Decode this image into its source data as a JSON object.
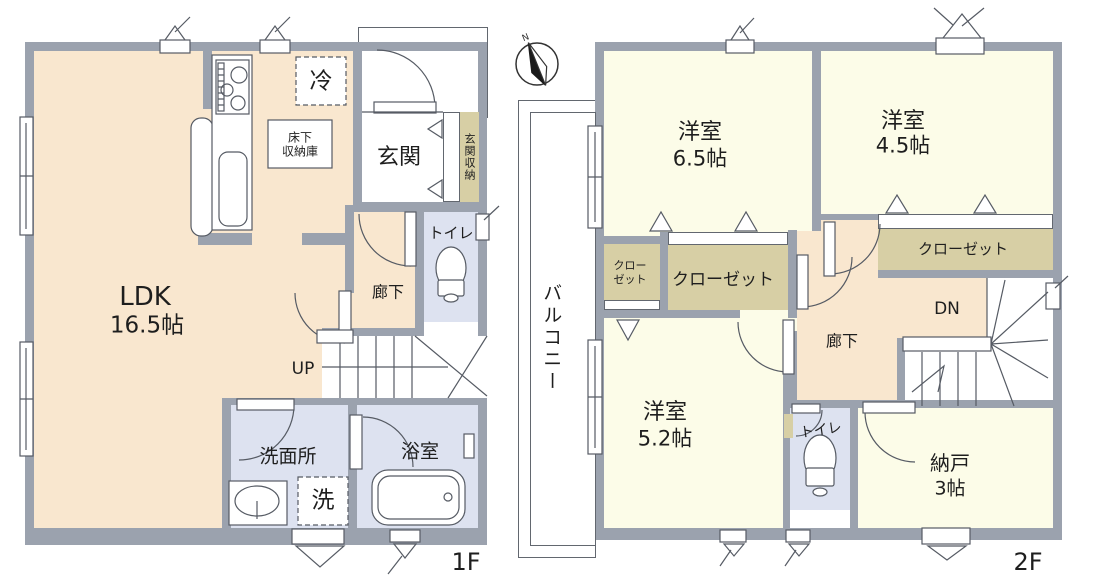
{
  "colors": {
    "wall": "#9ba2ae",
    "floor_living": "#f9e7cf",
    "floor_room": "#fcfce8",
    "floor_wet": "#dde2f0",
    "floor_closet": "#d7cfa5",
    "line": "#62676f"
  },
  "floor1": {
    "floor_label": "1F",
    "ldk_name": "LDK",
    "ldk_size": "16.5帖",
    "entrance": "玄関",
    "entrance_storage": "玄関収納",
    "toilet": "トイレ",
    "hallway": "廊下",
    "stairs": "UP",
    "washroom": "洗面所",
    "bathroom": "浴室",
    "fridge": "冷",
    "washer": "洗",
    "underfloor1": "床下",
    "underfloor2": "収納庫"
  },
  "floor2": {
    "floor_label": "2F",
    "balcony": "バルコニー",
    "room1_name": "洋室",
    "room1_size": "6.5帖",
    "room2_name": "洋室",
    "room2_size": "4.5帖",
    "room3_name": "洋室",
    "room3_size": "5.2帖",
    "closet": "クローゼット",
    "closet_small1": "クロー",
    "closet_small2": "ゼット",
    "storage_name": "納戸",
    "storage_size": "3帖",
    "toilet": "トイレ",
    "hallway": "廊下",
    "stairs": "DN",
    "compass": "N"
  }
}
